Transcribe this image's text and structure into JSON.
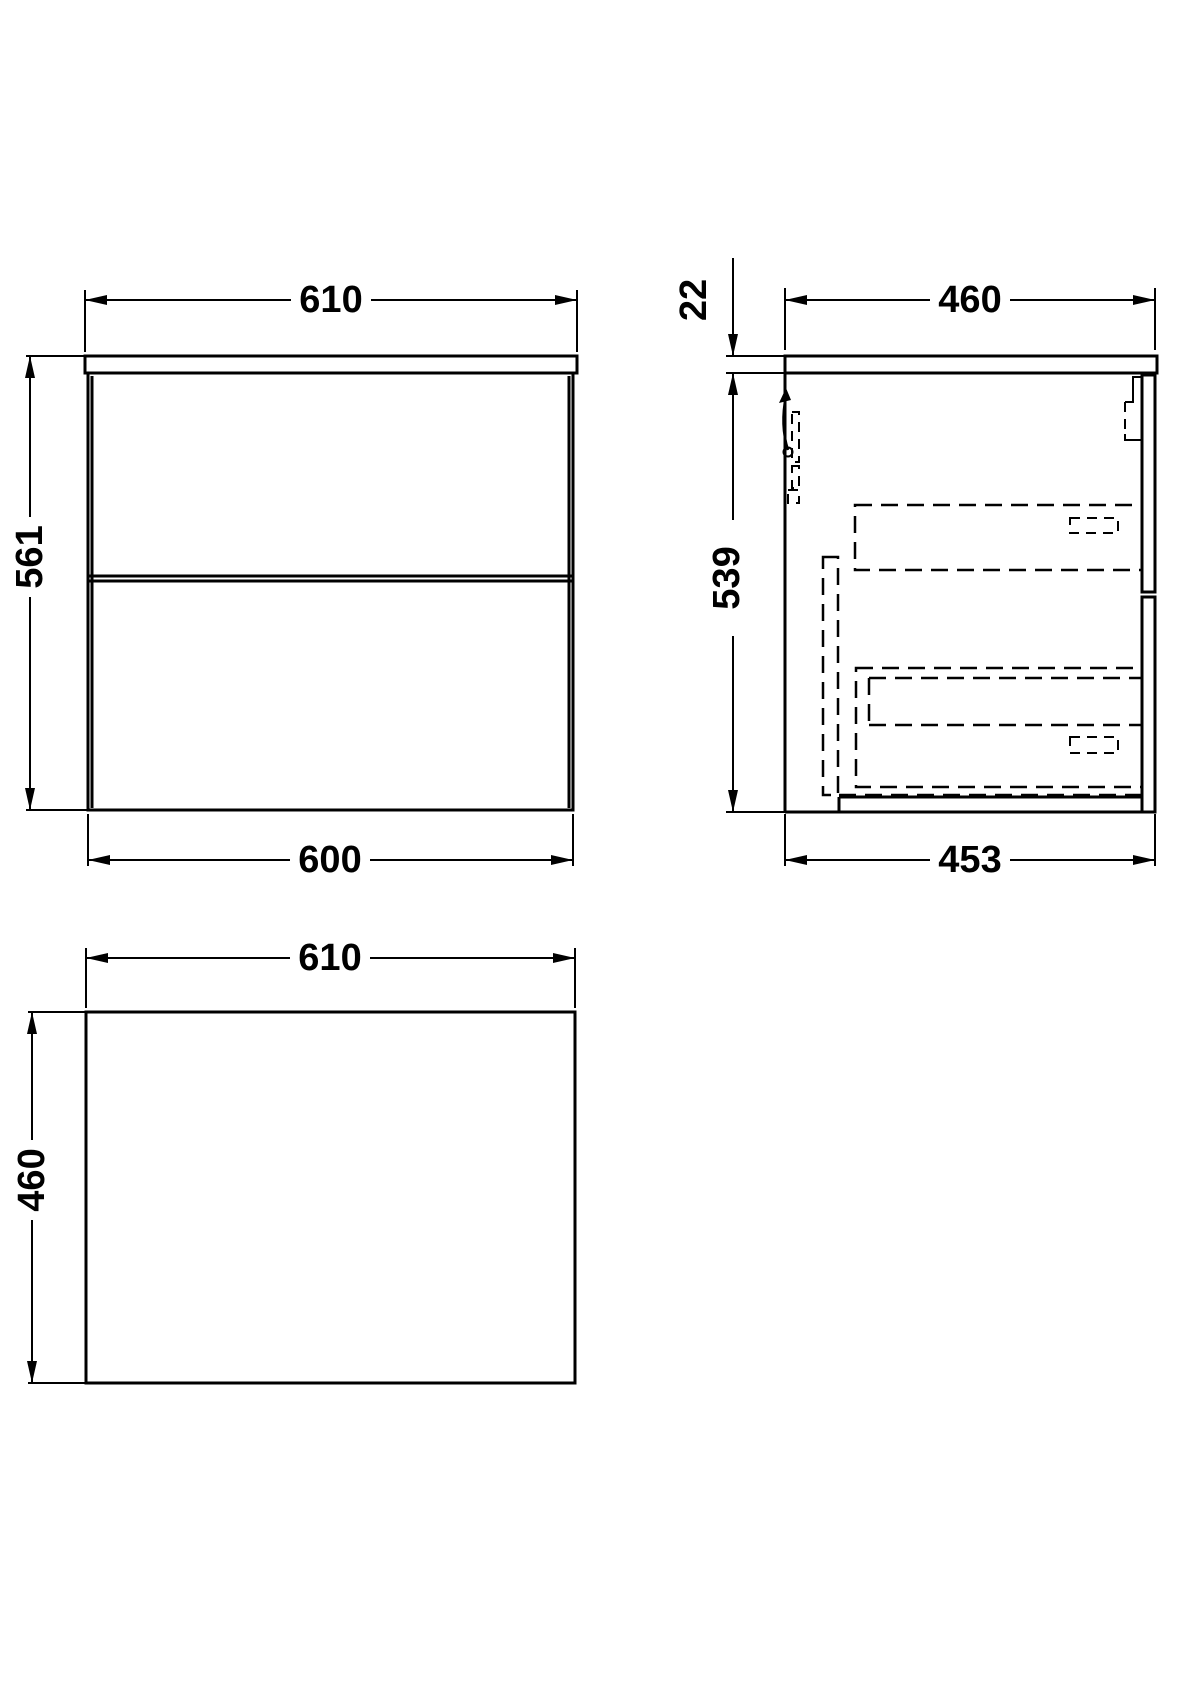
{
  "drawing_title": "vanity-unit-dimension-drawing",
  "colors": {
    "line": "#000000",
    "background": "#ffffff"
  },
  "views": {
    "front": {
      "width_top": "610",
      "height_left": "561",
      "width_bottom": "600"
    },
    "side": {
      "countertop_thickness": "22",
      "depth_top": "460",
      "height_left": "539",
      "depth_bottom": "453"
    },
    "plan": {
      "width_top": "610",
      "depth_left": "460"
    }
  }
}
